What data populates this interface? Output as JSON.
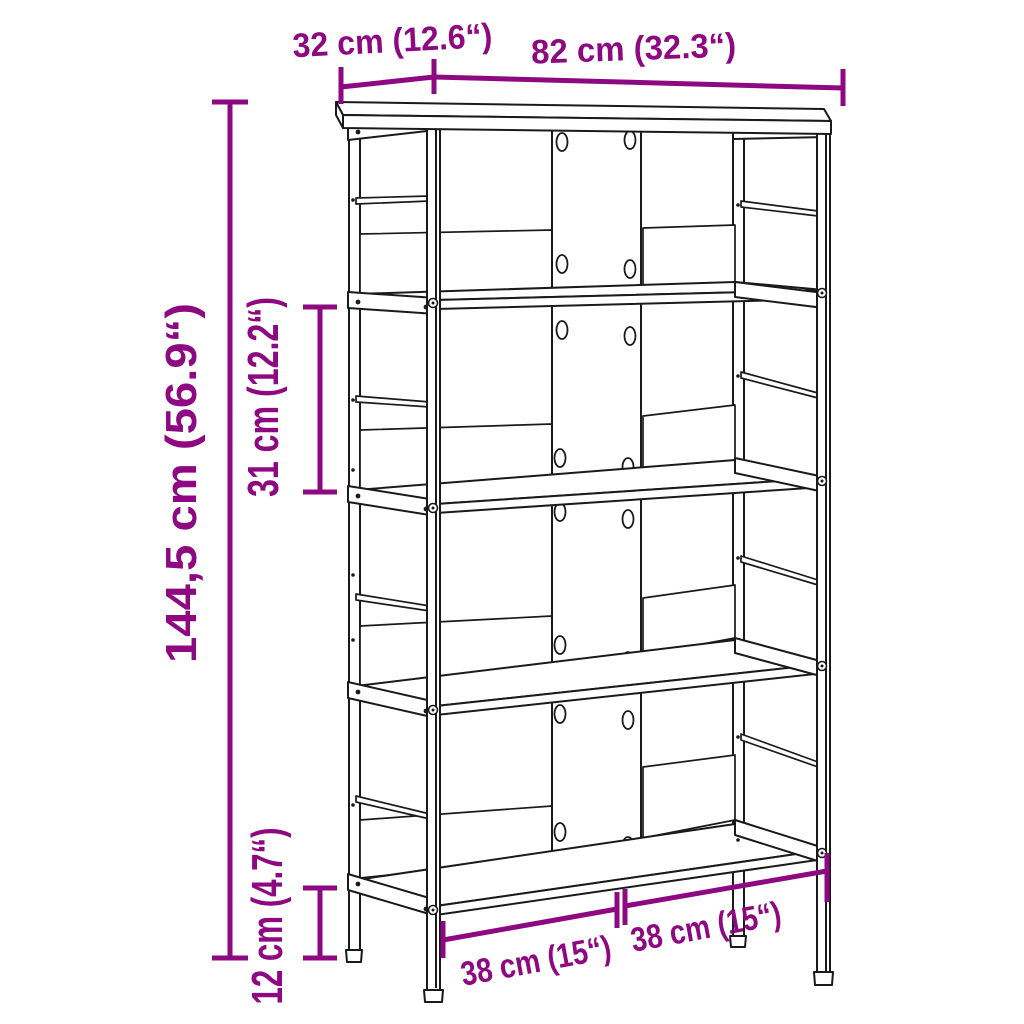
{
  "diagram": {
    "kind": "product dimension diagram",
    "subject": "4-tier open bookshelf line drawing, perspective view",
    "colors": {
      "dimension_accent": "#8E0981",
      "outline": "#1A1A1A",
      "background": "#FFFFFF"
    },
    "dimensions": {
      "depth": {
        "label": "32 cm (12.6“)"
      },
      "width": {
        "label": "82 cm (32.3“)"
      },
      "total_height": {
        "label": "144,5 cm (56.9“)"
      },
      "tier_height": {
        "label": "31 cm (12.2“)"
      },
      "bottom_clearance": {
        "label": "12 cm (4.7“)"
      },
      "left_compartment": {
        "label": "38 cm (15“)"
      },
      "right_compartment": {
        "label": "38 cm (15“)"
      }
    }
  }
}
